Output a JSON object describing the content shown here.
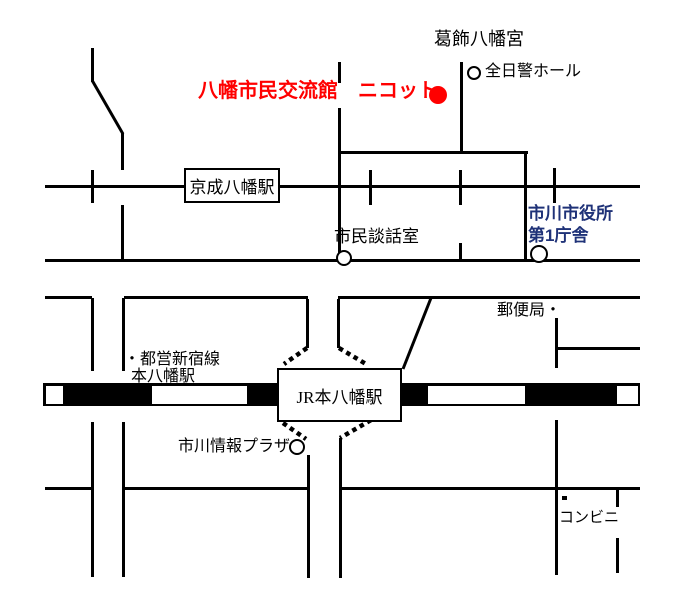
{
  "map": {
    "width": 700,
    "height": 610,
    "colors": {
      "line": "#000000",
      "accent_red": "#ff0000",
      "accent_blue": "#1f3278",
      "background": "#ffffff"
    },
    "labels": [
      {
        "name": "label-katsushika-hachimangu",
        "text": "葛飾八幡宮",
        "x": 434,
        "y": 29,
        "size": 18,
        "color": "#000000",
        "bold": false
      },
      {
        "name": "label-zennikkei-hall",
        "text": "全日警ホール",
        "x": 485,
        "y": 63,
        "size": 16,
        "color": "#000000",
        "bold": false
      },
      {
        "name": "label-nicot-title",
        "text": "八幡市民交流館　ニコット",
        "x": 198,
        "y": 80,
        "size": 20,
        "color": "#ff0000",
        "bold": true
      },
      {
        "name": "label-shimin-danwashitsu",
        "text": "市民談話室",
        "x": 334,
        "y": 227,
        "size": 17,
        "color": "#000000",
        "bold": false
      },
      {
        "name": "label-ichikawa-city-hall",
        "text": "市川市役所\n第1庁舎",
        "x": 528,
        "y": 203,
        "size": 17,
        "color": "#1f3278",
        "bold": true,
        "lh": 22
      },
      {
        "name": "label-post-office",
        "text": "郵便局・",
        "x": 497,
        "y": 302,
        "size": 16,
        "color": "#000000",
        "bold": false
      },
      {
        "name": "label-toei-shinjuku-line",
        "text": "・都営新宿線",
        "x": 124,
        "y": 351,
        "size": 16,
        "color": "#000000",
        "bold": false
      },
      {
        "name": "label-moto-yawata-station",
        "text": "本八幡駅",
        "x": 131,
        "y": 368,
        "size": 16,
        "color": "#000000",
        "bold": false
      },
      {
        "name": "label-ichikawa-joho-plaza",
        "text": "市川情報プラザ",
        "x": 178,
        "y": 438,
        "size": 16,
        "color": "#000000",
        "bold": false
      },
      {
        "name": "label-conbini",
        "text": "コンビニ",
        "x": 559,
        "y": 510,
        "size": 15,
        "color": "#000000",
        "bold": false
      }
    ],
    "station_boxes": [
      {
        "name": "keisei-yawata-station-box",
        "text": "京成八幡駅",
        "x": 184,
        "y": 168,
        "w": 96,
        "h": 35,
        "size": 17
      },
      {
        "name": "jr-moto-yawata-station-box",
        "text": "JR本八幡駅",
        "x": 277,
        "y": 368,
        "w": 125,
        "h": 54,
        "size": 17
      }
    ],
    "circles": [
      {
        "name": "zennikkei-hall-circle",
        "cx": 474,
        "cy": 73,
        "r": 7
      },
      {
        "name": "shimin-danwashitsu-circle",
        "cx": 344,
        "cy": 258,
        "r": 8
      },
      {
        "name": "city-hall-circle",
        "cx": 539,
        "cy": 254,
        "r": 9
      },
      {
        "name": "joho-plaza-circle",
        "cx": 297,
        "cy": 447,
        "r": 8
      },
      {
        "name": "nicot-location-dot",
        "cx": 438,
        "cy": 95,
        "r": 9,
        "fill": "#ff0000"
      }
    ],
    "roads": [
      {
        "name": "road-a",
        "x": 45,
        "y": 185,
        "w": 595,
        "h": 3
      },
      {
        "name": "road-b",
        "x": 45,
        "y": 259,
        "w": 595,
        "h": 3
      },
      {
        "name": "road-c-west",
        "x": 45,
        "y": 296,
        "w": 47,
        "h": 3
      },
      {
        "name": "road-c-mid",
        "x": 124,
        "y": 296,
        "w": 184,
        "h": 3
      },
      {
        "name": "road-c-east",
        "x": 338,
        "y": 296,
        "w": 302,
        "h": 3
      },
      {
        "name": "road-d-west",
        "x": 45,
        "y": 487,
        "w": 48,
        "h": 3
      },
      {
        "name": "road-d-mid",
        "x": 125,
        "y": 487,
        "w": 183,
        "h": 3
      },
      {
        "name": "road-d-east",
        "x": 341,
        "y": 487,
        "w": 299,
        "h": 3
      },
      {
        "name": "shrine-block-top-road",
        "x": 338,
        "y": 151,
        "w": 190,
        "h": 3
      },
      {
        "name": "post-office-branch-road",
        "x": 557,
        "y": 347,
        "w": 83,
        "h": 3
      },
      {
        "name": "shrine-street-west-upper",
        "x": 338,
        "y": 62,
        "w": 3,
        "h": 21
      },
      {
        "name": "shrine-street-west-lower",
        "x": 338,
        "y": 108,
        "w": 3,
        "h": 155
      },
      {
        "name": "shrine-street-east",
        "x": 460,
        "y": 62,
        "w": 3,
        "h": 92
      },
      {
        "name": "block-street-east",
        "x": 524,
        "y": 151,
        "w": 3,
        "h": 111
      },
      {
        "name": "bend-street-top",
        "x": 91,
        "y": 48,
        "w": 3,
        "h": 34
      },
      {
        "name": "bend-street-mid",
        "x": 121,
        "y": 133,
        "w": 3,
        "h": 37
      },
      {
        "name": "bend-street-lower",
        "x": 121,
        "y": 205,
        "w": 3,
        "h": 57
      },
      {
        "name": "cross-tick-a1",
        "x": 91,
        "y": 170,
        "w": 3,
        "h": 33
      },
      {
        "name": "cross-tick-a2",
        "x": 369,
        "y": 170,
        "w": 3,
        "h": 35
      },
      {
        "name": "cross-tick-a3",
        "x": 459,
        "y": 170,
        "w": 3,
        "h": 35
      },
      {
        "name": "cross-tick-a4",
        "x": 553,
        "y": 168,
        "w": 3,
        "h": 35
      },
      {
        "name": "cross-tick-b1",
        "x": 459,
        "y": 243,
        "w": 3,
        "h": 19
      },
      {
        "name": "west-corridor-left-upper",
        "x": 91,
        "y": 298,
        "w": 3,
        "h": 73
      },
      {
        "name": "west-corridor-right-upper",
        "x": 122,
        "y": 298,
        "w": 3,
        "h": 73
      },
      {
        "name": "west-corridor-left-lower",
        "x": 91,
        "y": 422,
        "w": 3,
        "h": 155
      },
      {
        "name": "west-corridor-right-lower",
        "x": 122,
        "y": 422,
        "w": 3,
        "h": 155
      },
      {
        "name": "station-corridor-left-upper",
        "x": 306,
        "y": 299,
        "w": 3,
        "h": 49
      },
      {
        "name": "station-corridor-right-upper",
        "x": 337,
        "y": 299,
        "w": 3,
        "h": 49
      },
      {
        "name": "station-corridor-left-lower",
        "x": 307,
        "y": 455,
        "w": 3,
        "h": 123
      },
      {
        "name": "station-corridor-right-lower",
        "x": 339,
        "y": 438,
        "w": 3,
        "h": 140
      },
      {
        "name": "post-office-street-upper",
        "x": 555,
        "y": 318,
        "w": 3,
        "h": 50
      },
      {
        "name": "post-office-street-lower",
        "x": 555,
        "y": 420,
        "w": 3,
        "h": 155
      },
      {
        "name": "conbini-street-upper",
        "x": 616,
        "y": 490,
        "w": 3,
        "h": 17
      },
      {
        "name": "conbini-street-lower",
        "x": 616,
        "y": 538,
        "w": 3,
        "h": 35
      },
      {
        "name": "conbini-marker-dot",
        "x": 562,
        "y": 496,
        "w": 5,
        "h": 4
      }
    ],
    "railway": {
      "name": "jr-sobu-line-band",
      "x": 43,
      "y": 383,
      "w": 597,
      "h": 23,
      "edge": 2.5,
      "black_segments": [
        {
          "name": "rail-black-1",
          "from": 63,
          "to": 152
        },
        {
          "name": "rail-black-2",
          "from": 247,
          "to": 428
        },
        {
          "name": "rail-black-3",
          "from": 525,
          "to": 617
        }
      ]
    },
    "diagonals": [
      {
        "name": "bend-street-diagonal",
        "x1": 92.5,
        "y1": 81,
        "x2": 123,
        "y2": 134
      },
      {
        "name": "jr-northeast-diagonal",
        "x1": 403,
        "y1": 369,
        "x2": 431,
        "y2": 298
      }
    ],
    "dotted_paths": [
      {
        "name": "jr-entrance-dotted-nw",
        "x1": 307,
        "y1": 348,
        "x2": 284,
        "y2": 364
      },
      {
        "name": "jr-entrance-dotted-ne",
        "x1": 339,
        "y1": 348,
        "x2": 366,
        "y2": 364
      },
      {
        "name": "jr-entrance-dotted-sw",
        "x1": 283,
        "y1": 423,
        "x2": 306,
        "y2": 439
      },
      {
        "name": "jr-entrance-dotted-se",
        "x1": 371,
        "y1": 420,
        "x2": 340,
        "y2": 438
      }
    ]
  }
}
